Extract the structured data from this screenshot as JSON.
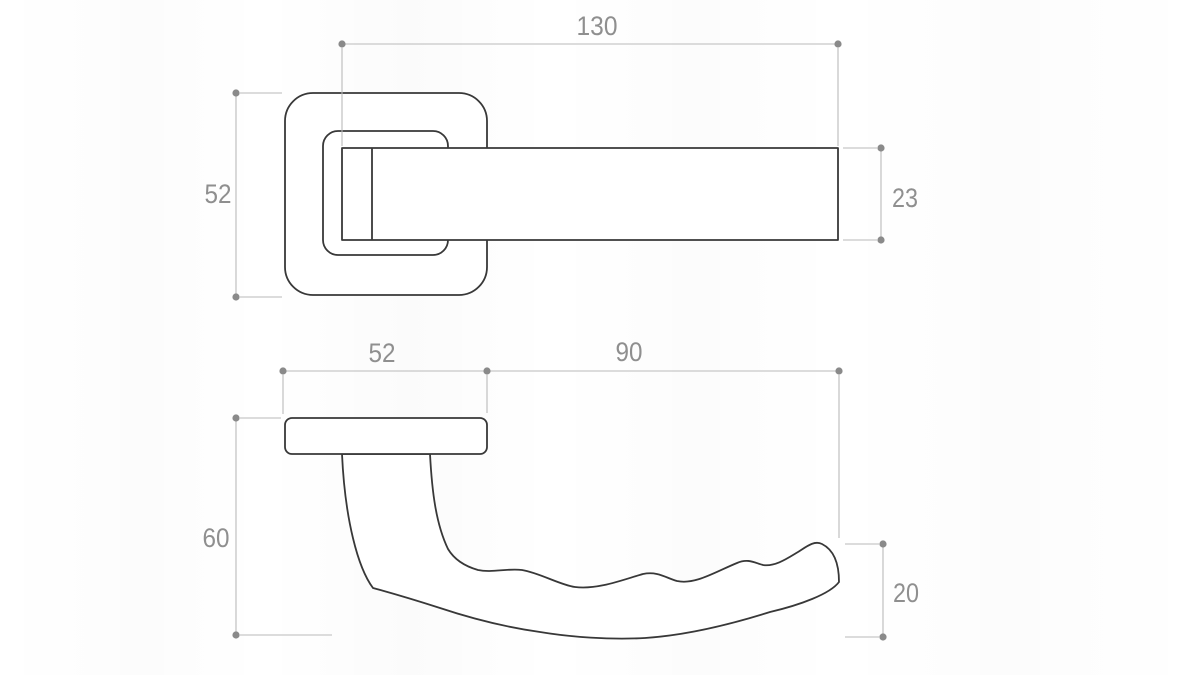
{
  "document": {
    "kind": "technical-dimension-drawing",
    "subject": "door-lever-handle-on-square-rosette",
    "units_shown": false,
    "background_color": "#ffffff",
    "object_line_color": "#383838",
    "dimension_line_color": "#bababa",
    "dimension_dot_color": "#8a8a8a",
    "label_text_color": "#8f8f8f"
  },
  "front_view": {
    "name": "front view (handle face-on)",
    "dims": {
      "overall_length": "130",
      "rosette_height": "52",
      "lever_thickness": "23"
    }
  },
  "side_view": {
    "name": "side view (handle profile)",
    "dims": {
      "rosette_width": "52",
      "grip_length": "90",
      "projection_depth": "60",
      "grip_thickness": "20"
    }
  }
}
